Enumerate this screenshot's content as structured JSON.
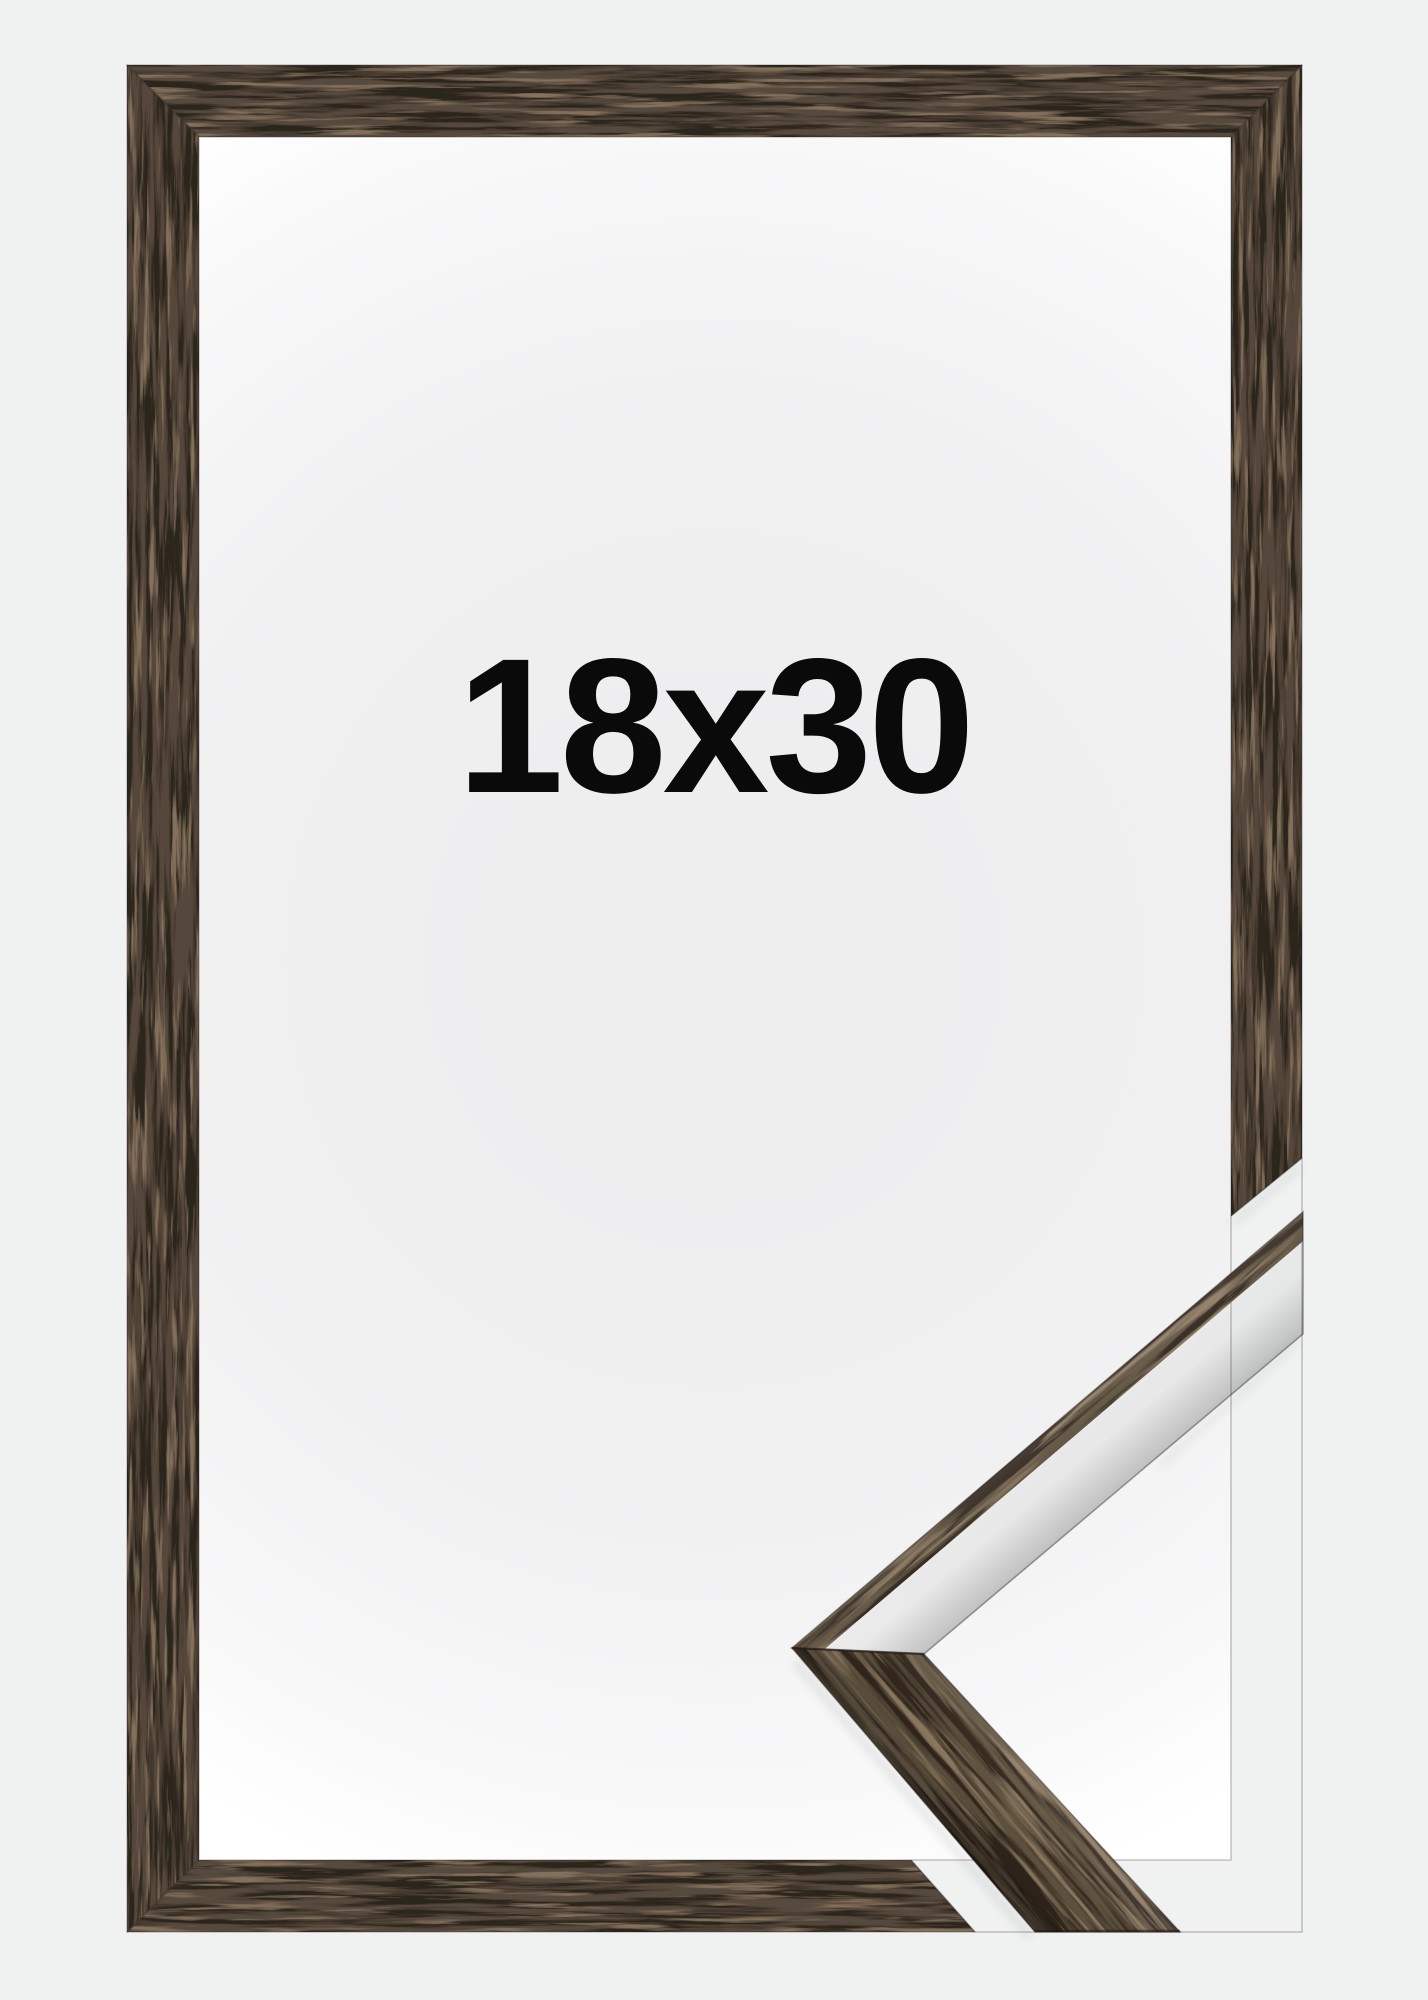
{
  "product": {
    "size_label": "18x30",
    "item": "wooden picture frame",
    "finish": "dark walnut brown wood"
  },
  "palette": {
    "background": "#f0f1f1",
    "interior_center": "#ededee",
    "interior_edge": "#ffffff",
    "wood_base": "#57493c",
    "wood_detail_base": "#60523f",
    "wood_dark_streak": "#2c251e",
    "wood_light_fleck": "#84715c",
    "seam_line": "#241d17",
    "text_color": "#0a0a0a"
  }
}
